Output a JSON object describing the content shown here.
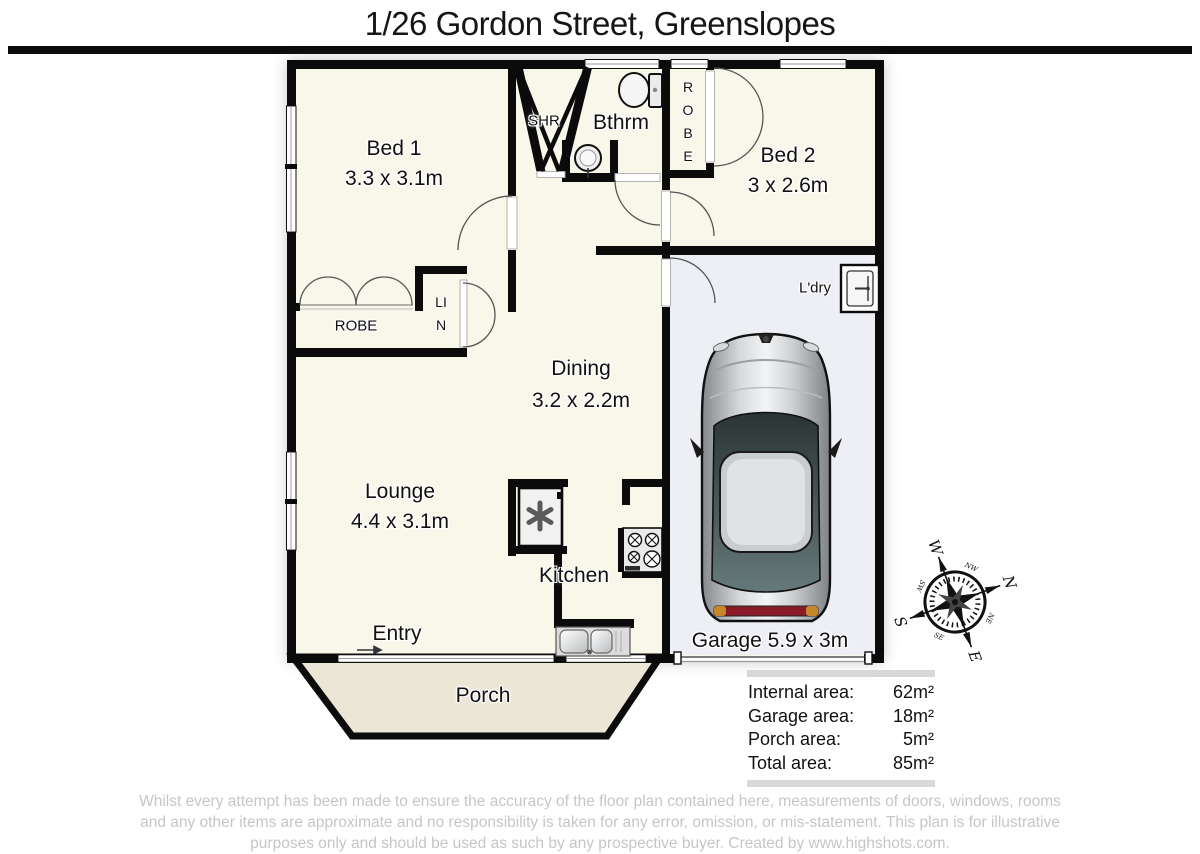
{
  "title": "1/26 Gordon Street, Greenslopes",
  "rooms": {
    "bed1": {
      "name": "Bed 1",
      "dims": "3.3 x 3.1m"
    },
    "bed2": {
      "name": "Bed 2",
      "dims": "3 x 2.6m"
    },
    "dining": {
      "name": "Dining",
      "dims": "3.2 x 2.2m"
    },
    "lounge": {
      "name": "Lounge",
      "dims": "4.4 x 3.1m"
    },
    "kitchen": {
      "name": "Kitchen"
    },
    "bathroom": {
      "name": "Bthrm"
    },
    "shower": {
      "name": "SHR"
    },
    "laundry": {
      "name": "L'dry"
    },
    "entry": {
      "name": "Entry"
    },
    "porch": {
      "name": "Porch"
    },
    "garage": {
      "name": "Garage",
      "dims": "5.9 x 3m"
    },
    "robe_bed1": {
      "name": "ROBE"
    },
    "robe_bed2": {
      "name": "ROBE"
    },
    "linen": {
      "name": "LIN"
    }
  },
  "areas": [
    {
      "label": "Internal area:",
      "value": "62m²"
    },
    {
      "label": "Garage area:",
      "value": "18m²"
    },
    {
      "label": "Porch area:",
      "value": "5m²"
    },
    {
      "label": "Total area:",
      "value": "85m²"
    }
  ],
  "compass": {
    "n": "N",
    "e": "E",
    "s": "S",
    "w": "W",
    "ne": "NE",
    "nw": "NW",
    "se": "SE",
    "sw": "SW"
  },
  "disclaimer": {
    "lines": [
      "Whilst every attempt has been made to ensure the accuracy of the floor plan contained here, measurements of doors, windows, rooms",
      "and any other items are approximate and no responsibility is taken for any error, omission, or mis-statement. This plan is for illustrative",
      "purposes only and should be used as such by any prospective buyer.  Created by www.highshots.com."
    ]
  },
  "icons": {
    "entry_arrow": "→"
  },
  "colors": {
    "wall": "#0b0b0b",
    "floor": "#f9f6ea",
    "garage_floor": "#edeff5",
    "porch": "#ece6d7",
    "title_rule": "#0b0b0b",
    "area_bar": "#d8d8d8",
    "disclaimer_text": "#c6c6c6",
    "car_tail_light": "#8a1a28"
  }
}
